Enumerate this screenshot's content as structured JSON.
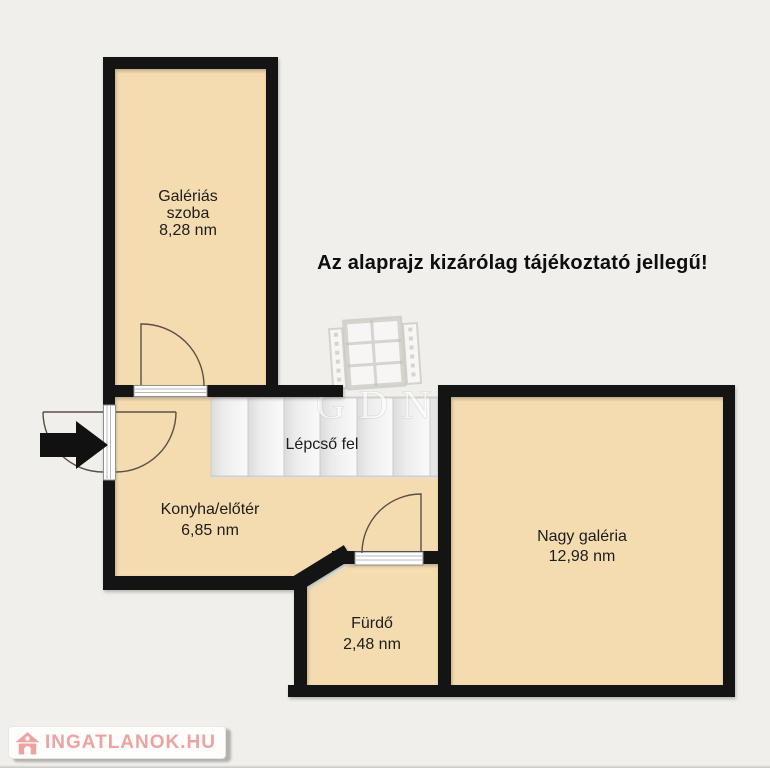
{
  "notice": {
    "text": "Az alaprajz kizárólag tájékoztató jellegű!"
  },
  "rooms": [
    {
      "id": "galerias-szoba",
      "name_line1": "Galériás",
      "name_line2": "szoba",
      "area": "8,28 nm"
    },
    {
      "id": "konyha-eloter",
      "name": "Konyha/előtér",
      "area": "6,85 nm"
    },
    {
      "id": "furdo",
      "name": "Fürdő",
      "area": "2,48 nm"
    },
    {
      "id": "nagy-galeria",
      "name": "Nagy galéria",
      "area": "12,98 nm"
    }
  ],
  "stairs": {
    "label": "Lépcső fel"
  },
  "watermark": {
    "text": "GDN"
  },
  "logo": {
    "text": "INGATLANOK.HU"
  },
  "colors": {
    "background": "#f0efeb",
    "room_fill": "#f5dcb0",
    "wall": "#141414",
    "stair_fill": "#ebebeb",
    "door_line": "#5a5044",
    "logo_accent": "#eca3a1",
    "label_color": "#1c1c1c"
  }
}
